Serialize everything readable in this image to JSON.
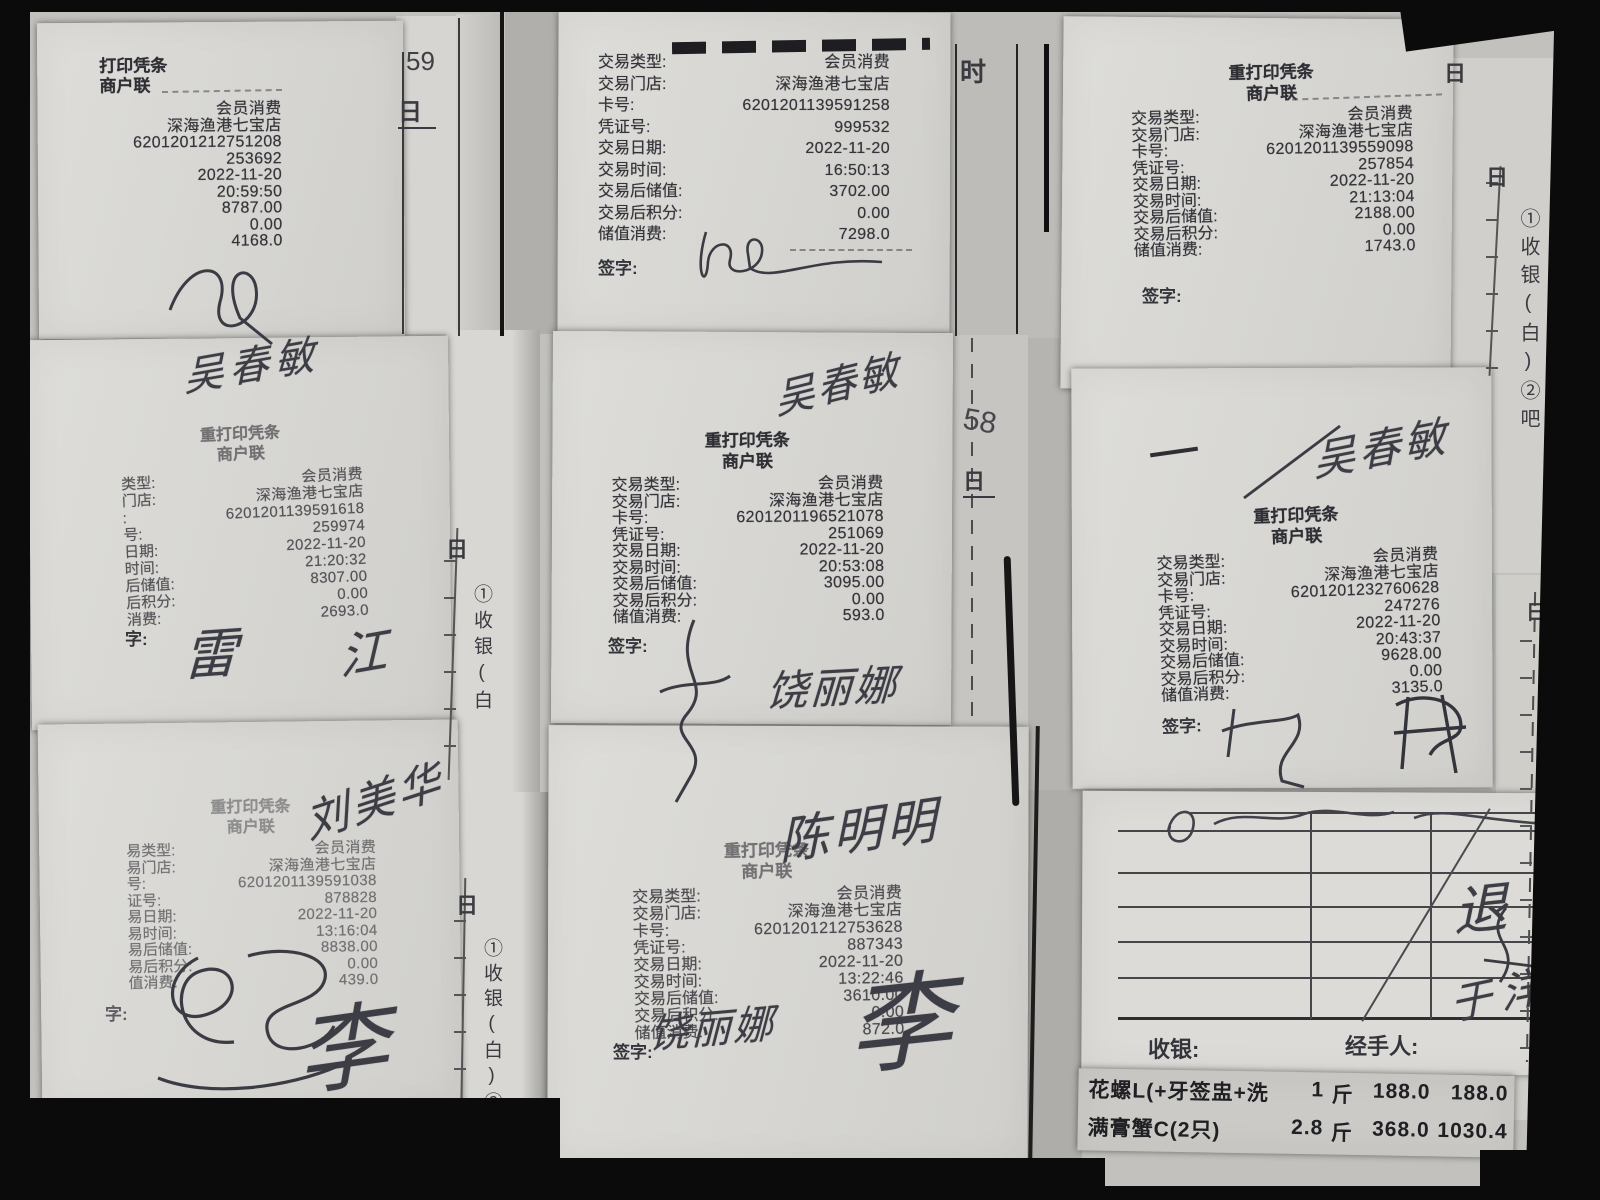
{
  "receipts": [
    {
      "position": "top-left",
      "header": [
        "打印凭条",
        "商户联"
      ],
      "sign_label": "",
      "rows": [
        {
          "label": "",
          "value": "会员消费"
        },
        {
          "label": "",
          "value": "深海渔港七宝店"
        },
        {
          "label": "",
          "value": "6201201212751208"
        },
        {
          "label": "",
          "value": "253692"
        },
        {
          "label": "",
          "value": "2022-11-20"
        },
        {
          "label": "",
          "value": "20:59:50"
        },
        {
          "label": "",
          "value": "8787.00"
        },
        {
          "label": "",
          "value": "0.00"
        },
        {
          "label": "",
          "value": "4168.0"
        }
      ]
    },
    {
      "position": "top-center",
      "header": [],
      "sign_label": "签字:",
      "rows": [
        {
          "label": "交易类型:",
          "value": "会员消费"
        },
        {
          "label": "交易门店:",
          "value": "深海渔港七宝店"
        },
        {
          "label": "卡号:",
          "value": "6201201139591258"
        },
        {
          "label": "凭证号:",
          "value": "999532"
        },
        {
          "label": "交易日期:",
          "value": "2022-11-20"
        },
        {
          "label": "交易时间:",
          "value": "16:50:13"
        },
        {
          "label": "交易后储值:",
          "value": "3702.00"
        },
        {
          "label": "交易后积分:",
          "value": "0.00"
        },
        {
          "label": "储值消费:",
          "value": "7298.0"
        }
      ]
    },
    {
      "position": "top-right",
      "header": [
        "重打印凭条",
        "商户联"
      ],
      "sign_label": "签字:",
      "rows": [
        {
          "label": "交易类型:",
          "value": "会员消费"
        },
        {
          "label": "交易门店:",
          "value": "深海渔港七宝店"
        },
        {
          "label": "卡号:",
          "value": "6201201139559098"
        },
        {
          "label": "凭证号:",
          "value": "257854"
        },
        {
          "label": "交易日期:",
          "value": "2022-11-20"
        },
        {
          "label": "交易时间:",
          "value": "21:13:04"
        },
        {
          "label": "交易后储值:",
          "value": "2188.00"
        },
        {
          "label": "交易后积分:",
          "value": "0.00"
        },
        {
          "label": "储值消费:",
          "value": "1743.0"
        }
      ]
    },
    {
      "position": "middle-left",
      "header": [
        "重打印凭条",
        "商户联"
      ],
      "sign_label": "字:",
      "rows": [
        {
          "label": "类型:",
          "value": "会员消费"
        },
        {
          "label": "门店:",
          "value": "深海渔港七宝店"
        },
        {
          "label": ":",
          "value": "6201201139591618"
        },
        {
          "label": "号:",
          "value": "259974"
        },
        {
          "label": "日期:",
          "value": "2022-11-20"
        },
        {
          "label": "时间:",
          "value": "21:20:32"
        },
        {
          "label": "后储值:",
          "value": "8307.00"
        },
        {
          "label": "后积分:",
          "value": "0.00"
        },
        {
          "label": "消费:",
          "value": "2693.0"
        }
      ]
    },
    {
      "position": "middle-center",
      "header": [
        "重打印凭条",
        "商户联"
      ],
      "sign_label": "签字:",
      "rows": [
        {
          "label": "交易类型:",
          "value": "会员消费"
        },
        {
          "label": "交易门店:",
          "value": "深海渔港七宝店"
        },
        {
          "label": "卡号:",
          "value": "6201201196521078"
        },
        {
          "label": "凭证号:",
          "value": "251069"
        },
        {
          "label": "交易日期:",
          "value": "2022-11-20"
        },
        {
          "label": "交易时间:",
          "value": "20:53:08"
        },
        {
          "label": "交易后储值:",
          "value": "3095.00"
        },
        {
          "label": "交易后积分:",
          "value": "0.00"
        },
        {
          "label": "储值消费:",
          "value": "593.0"
        }
      ]
    },
    {
      "position": "middle-right",
      "header": [
        "重打印凭条",
        "商户联"
      ],
      "sign_label": "签字:",
      "rows": [
        {
          "label": "交易类型:",
          "value": "会员消费"
        },
        {
          "label": "交易门店:",
          "value": "深海渔港七宝店"
        },
        {
          "label": "卡号:",
          "value": "6201201232760628"
        },
        {
          "label": "凭证号:",
          "value": "247276"
        },
        {
          "label": "交易日期:",
          "value": "2022-11-20"
        },
        {
          "label": "交易时间:",
          "value": "20:43:37"
        },
        {
          "label": "交易后储值:",
          "value": "9628.00"
        },
        {
          "label": "交易后积分:",
          "value": "0.00"
        },
        {
          "label": "储值消费:",
          "value": "3135.0"
        }
      ]
    },
    {
      "position": "bottom-left",
      "header": [
        "重打印凭条",
        "商户联"
      ],
      "sign_label": "字:",
      "rows": [
        {
          "label": "易类型:",
          "value": "会员消费"
        },
        {
          "label": "易门店:",
          "value": "深海渔港七宝店"
        },
        {
          "label": "号:",
          "value": "6201201139591038"
        },
        {
          "label": "证号:",
          "value": "878828"
        },
        {
          "label": "易日期:",
          "value": "2022-11-20"
        },
        {
          "label": "易时间:",
          "value": "13:16:04"
        },
        {
          "label": "易后储值:",
          "value": "8838.00"
        },
        {
          "label": "易后积分:",
          "value": "0.00"
        },
        {
          "label": "值消费:",
          "value": "439.0"
        }
      ]
    },
    {
      "position": "bottom-center",
      "header": [
        "重打印凭条",
        "商户联"
      ],
      "sign_label": "签字:",
      "rows": [
        {
          "label": "交易类型:",
          "value": "会员消费"
        },
        {
          "label": "交易门店:",
          "value": "深海渔港七宝店"
        },
        {
          "label": "卡号:",
          "value": "6201201212753628"
        },
        {
          "label": "凭证号:",
          "value": "887343"
        },
        {
          "label": "交易日期:",
          "value": "2022-11-20"
        },
        {
          "label": "交易时间:",
          "value": "13:22:46"
        },
        {
          "label": "交易后储值:",
          "value": "3610.00"
        },
        {
          "label": "交易后积分:",
          "value": "0.00"
        },
        {
          "label": "储值消费:",
          "value": "872.0"
        }
      ]
    }
  ],
  "handwriting": {
    "wu_chunmin": "吴春敏",
    "liu_meihua": "刘美华",
    "chen_mingming": "陈明明",
    "rao_lina": "饶丽娜",
    "li": "李",
    "lei": "雷",
    "jiang": "江",
    "tui": "退",
    "yu_yang": "于洋"
  },
  "margins": {
    "day_label": "日",
    "num_59": "59",
    "num_58": "58",
    "partial_shi": "时",
    "strip_a": "①收银(白",
    "strip_b": "①收银(白)②吧",
    "strip_c": "①收银(白)②吧",
    "strip_d": "①收银(白)②吧台(红)③服务员(绿)"
  },
  "form": {
    "cashier_label": "收银:",
    "handler_label": "经手人:"
  },
  "items": {
    "rows": [
      {
        "name": "花螺L(+牙签盅+洗",
        "qty": "1",
        "unit": "斤",
        "price": "188.0",
        "amount": "188.0"
      },
      {
        "name": "满膏蟹C(2只)",
        "qty": "2.8",
        "unit": "斤",
        "price": "368.0",
        "amount": "1030.4"
      }
    ]
  }
}
